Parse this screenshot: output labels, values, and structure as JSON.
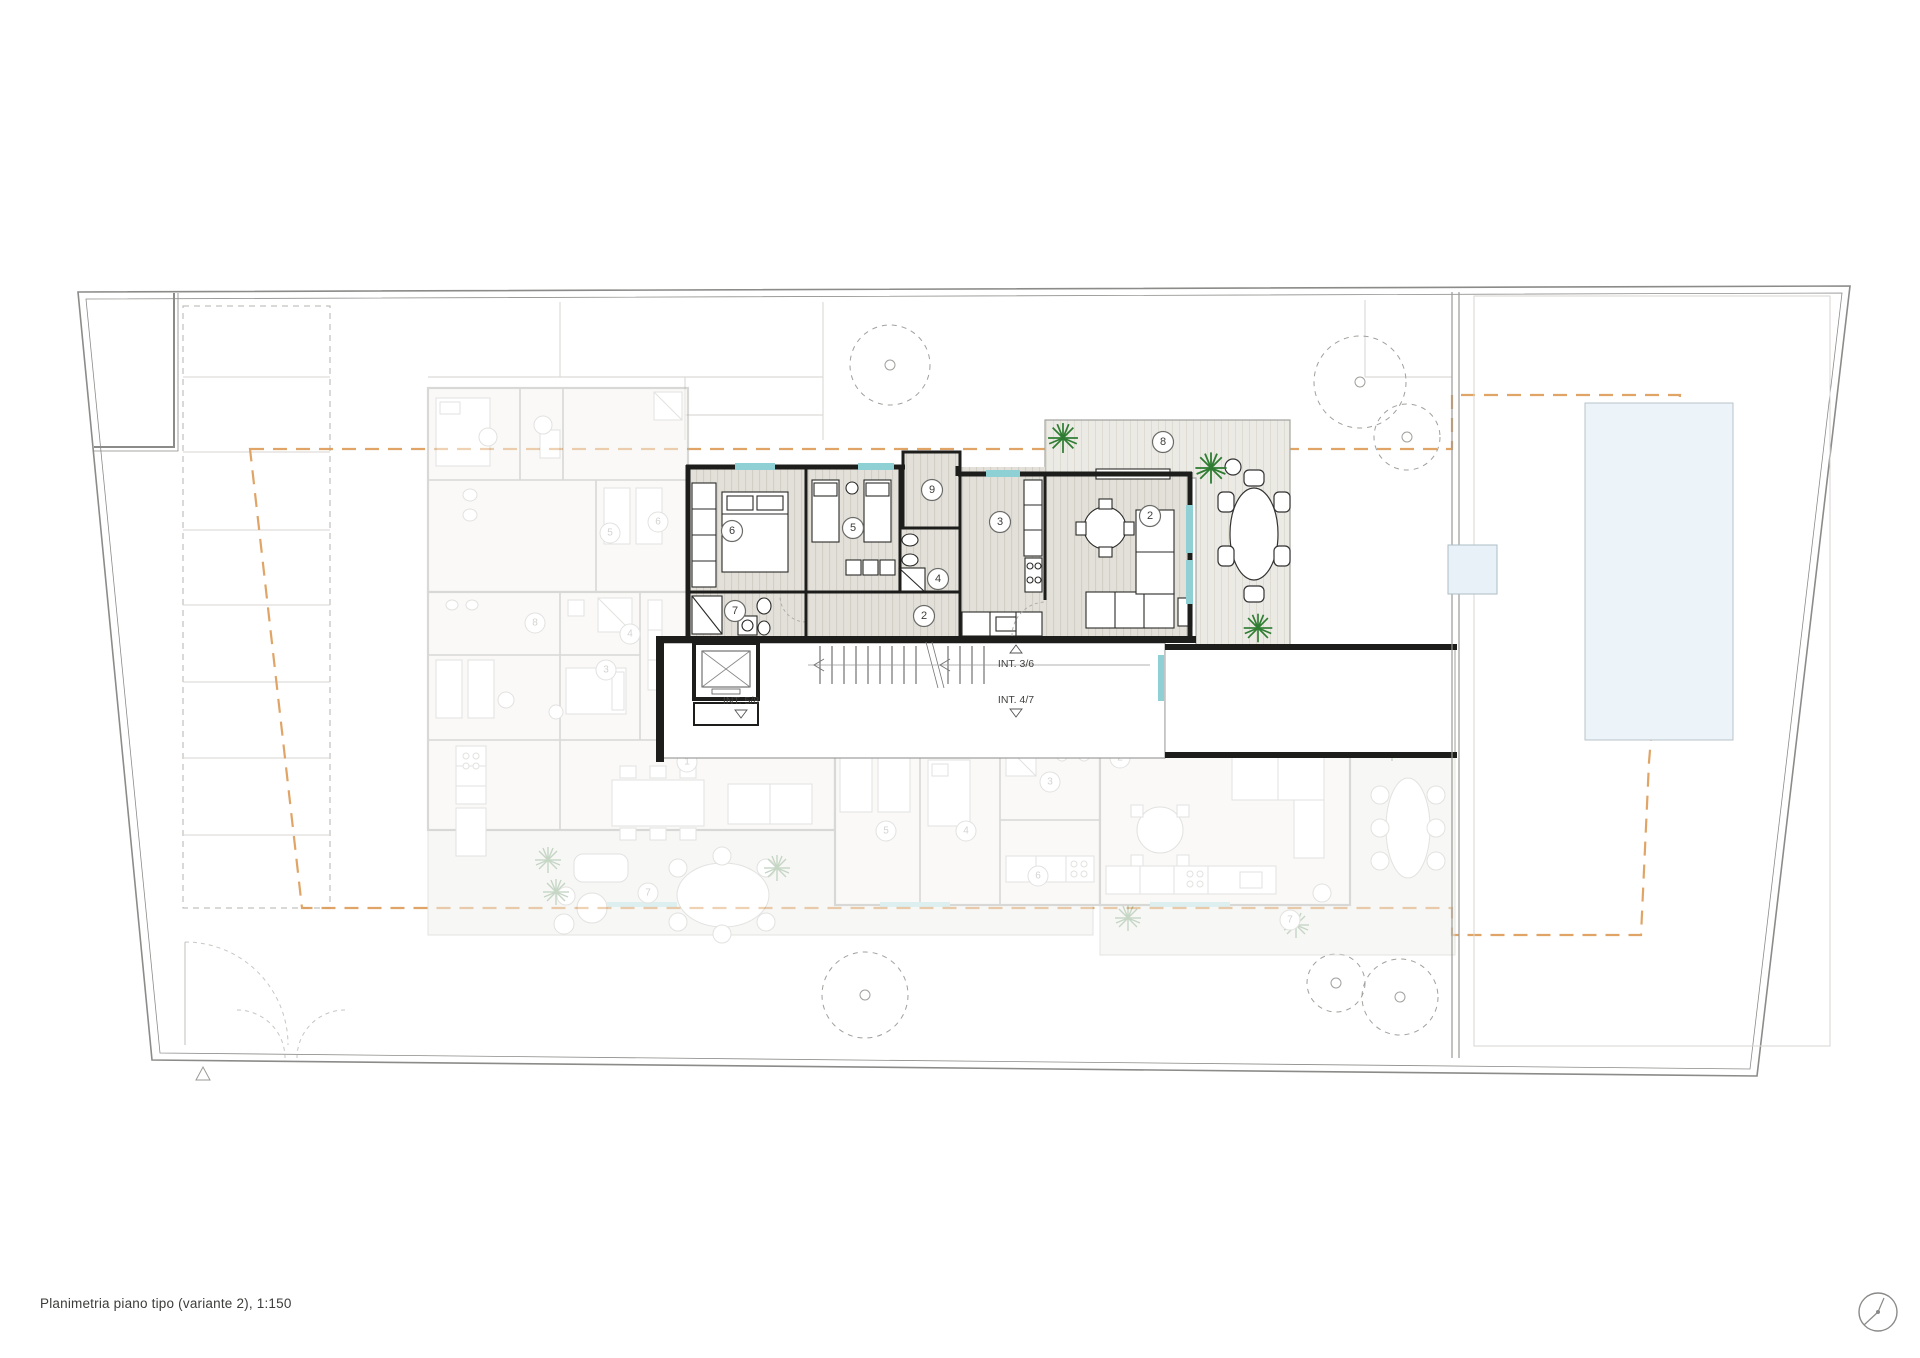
{
  "document": {
    "caption": "Planimetria piano tipo (variante 2), 1:150"
  },
  "stair_core": {
    "label_left": "INT. 5/8",
    "label_upper_right": "INT. 3/6",
    "label_lower_right": "INT. 4/7"
  },
  "badges": {
    "main": [
      "6",
      "5",
      "9",
      "7",
      "4",
      "2",
      "3",
      "2",
      "8"
    ],
    "other": [
      "5",
      "6",
      "8",
      "4",
      "3",
      "2",
      "1",
      "7",
      "1",
      "5",
      "4",
      "3",
      "6",
      "2",
      "7"
    ]
  },
  "colors": {
    "envelope_dashed": "#DD9A55",
    "window_glazing": "#8FD0D4",
    "pool_water": "#ECF3F9",
    "wall": "#1D1D1B",
    "faded_wall": "#B2B2AF",
    "palm": "#2E7D32"
  },
  "icons": {
    "trees": "tree-canopy-dashed-circle",
    "palms": "palm-star",
    "north": "north-indicator-circle"
  }
}
